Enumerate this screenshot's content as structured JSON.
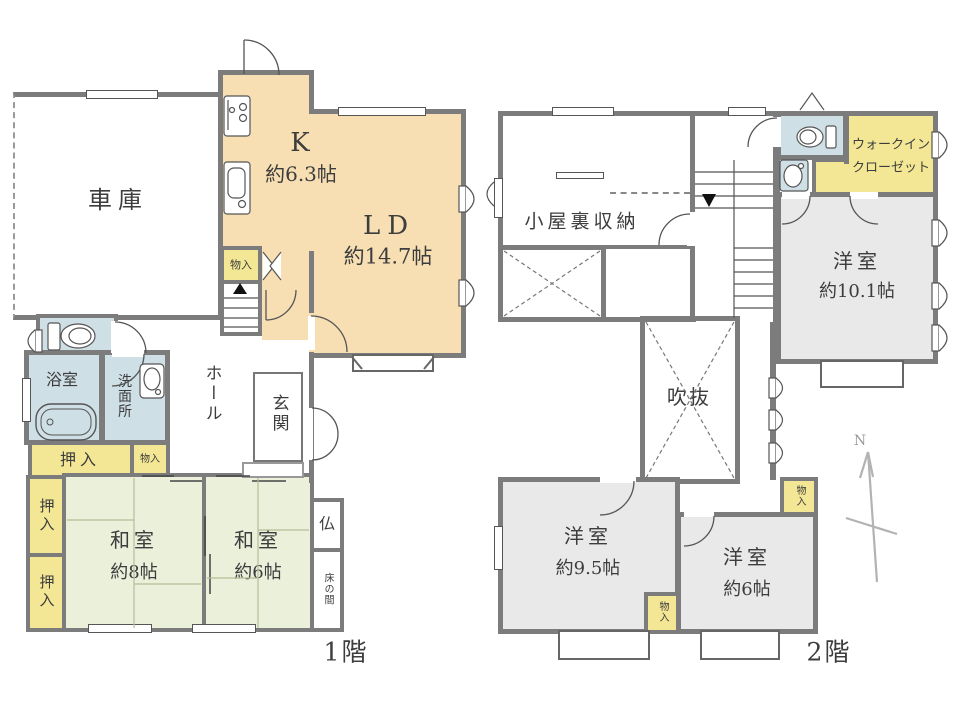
{
  "colors": {
    "wall": "#7c7c7c",
    "kitchen_ld": "#f7dfb3",
    "tatami": "#eaf0da",
    "closet": "#f3e795",
    "wet_area": "#cfdfe6",
    "western_room": "#e9e9e9"
  },
  "floor1": {
    "label": "1階",
    "garage": "車庫",
    "kitchen_name": "K",
    "kitchen_size": "約6.3帖",
    "ld_name": "LD",
    "ld_size": "約14.7帖",
    "storage_stairs": "物入",
    "hall": "ホール",
    "entrance": "玄関",
    "bathroom": "浴室",
    "washroom": "洗面所",
    "closet_top": "押入",
    "storage_small": "物入",
    "closet_left_upper": "押入",
    "closet_left_lower": "押入",
    "washitsu8_name": "和室",
    "washitsu8_size": "約8帖",
    "washitsu6_name": "和室",
    "washitsu6_size": "約6帖",
    "butsudan": "仏",
    "tokonoma": "床の間"
  },
  "floor2": {
    "label": "2階",
    "attic_storage": "小屋裏収納",
    "wic_line1": "ウォークイン",
    "wic_line2": "クローゼット",
    "room101_name": "洋室",
    "room101_size": "約10.1帖",
    "void_label": "吹抜",
    "room95_name": "洋室",
    "room95_size": "約9.5帖",
    "room6_name": "洋室",
    "room6_size": "約6帖",
    "storage_a": "物入",
    "storage_b": "物入",
    "north": "N"
  }
}
